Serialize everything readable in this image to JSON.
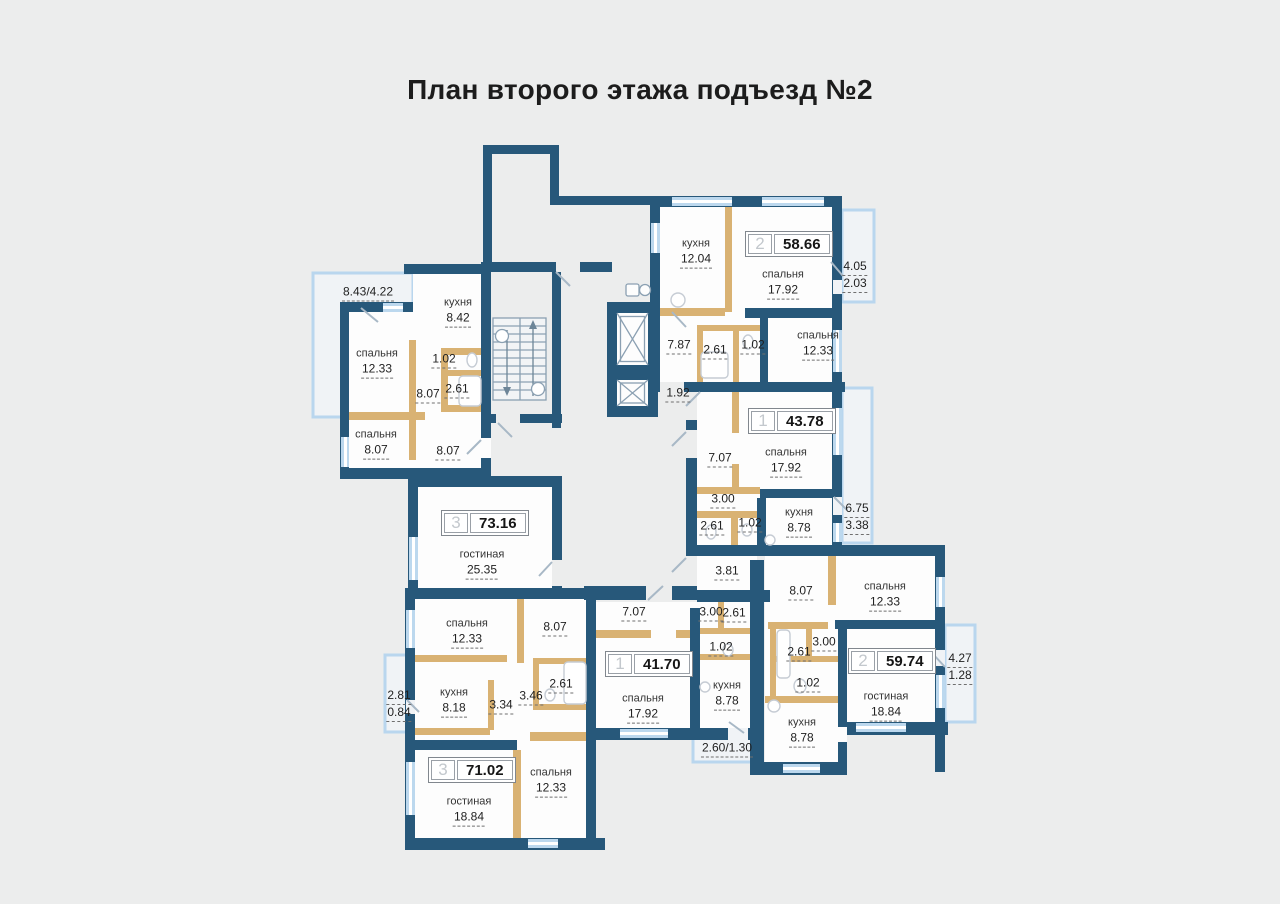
{
  "title": "План второго этажа подъезд №2",
  "colors": {
    "background": "#eceded",
    "wall": "#27587a",
    "partition": "#d9b273",
    "window": "#bcd8ee",
    "balcony_outline": "#b9d6ee",
    "room_fill": "#fdfdfd"
  },
  "icons": {
    "stairs": "double-flight-staircase-with-arrows",
    "elevator": "elevator-shaft-x",
    "chute": "garbage-chute"
  },
  "plan": {
    "badges": [
      {
        "rooms": "3",
        "area": "73.16"
      },
      {
        "rooms": "2",
        "area": "58.66"
      },
      {
        "rooms": "1",
        "area": "43.78"
      },
      {
        "rooms": "2",
        "area": "59.74"
      },
      {
        "rooms": "1",
        "area": "41.70"
      },
      {
        "rooms": "3",
        "area": "71.02"
      }
    ],
    "rooms": [
      {
        "name": "кухня",
        "area": "8.42"
      },
      {
        "name": "спальня",
        "area": "12.33"
      },
      {
        "name": "спальня",
        "area": "8.07"
      },
      {
        "name": "гостиная",
        "area": "25.35"
      },
      {
        "name": "кухня",
        "area": "12.04"
      },
      {
        "name": "спальня",
        "area": "17.92"
      },
      {
        "name": "спальня",
        "area": "12.33"
      },
      {
        "name": "спальня",
        "area": "17.92"
      },
      {
        "name": "кухня",
        "area": "8.78"
      },
      {
        "name": "спальня",
        "area": "12.33"
      },
      {
        "name": "гостиная",
        "area": "18.84"
      },
      {
        "name": "кухня",
        "area": "8.78"
      },
      {
        "name": "спальня",
        "area": "17.92"
      },
      {
        "name": "кухня",
        "area": "8.78"
      },
      {
        "name": "спальня",
        "area": "12.33"
      },
      {
        "name": "кухня",
        "area": "8.18"
      },
      {
        "name": "гостиная",
        "area": "18.84"
      },
      {
        "name": "спальня",
        "area": "12.33"
      }
    ],
    "dims": [
      "1.02",
      "8.07",
      "2.61",
      "8.07",
      "7.87",
      "2.61",
      "1.02",
      "1.92",
      "7.07",
      "3.00",
      "2.61",
      "1.02",
      "3.81",
      "8.07",
      "3.00",
      "2.61",
      "1.02",
      "7.07",
      "3.00",
      "2.61",
      "1.02",
      "8.07",
      "3.34",
      "3.46",
      "2.61"
    ],
    "balconies": [
      {
        "label": "8.43/4.22"
      },
      {
        "top": "4.05",
        "bottom": "2.03"
      },
      {
        "top": "6.75",
        "bottom": "3.38"
      },
      {
        "top": "4.27",
        "bottom": "1.28"
      },
      {
        "label": "2.60/1.30"
      },
      {
        "top": "2.81",
        "bottom": "0.84"
      }
    ]
  }
}
